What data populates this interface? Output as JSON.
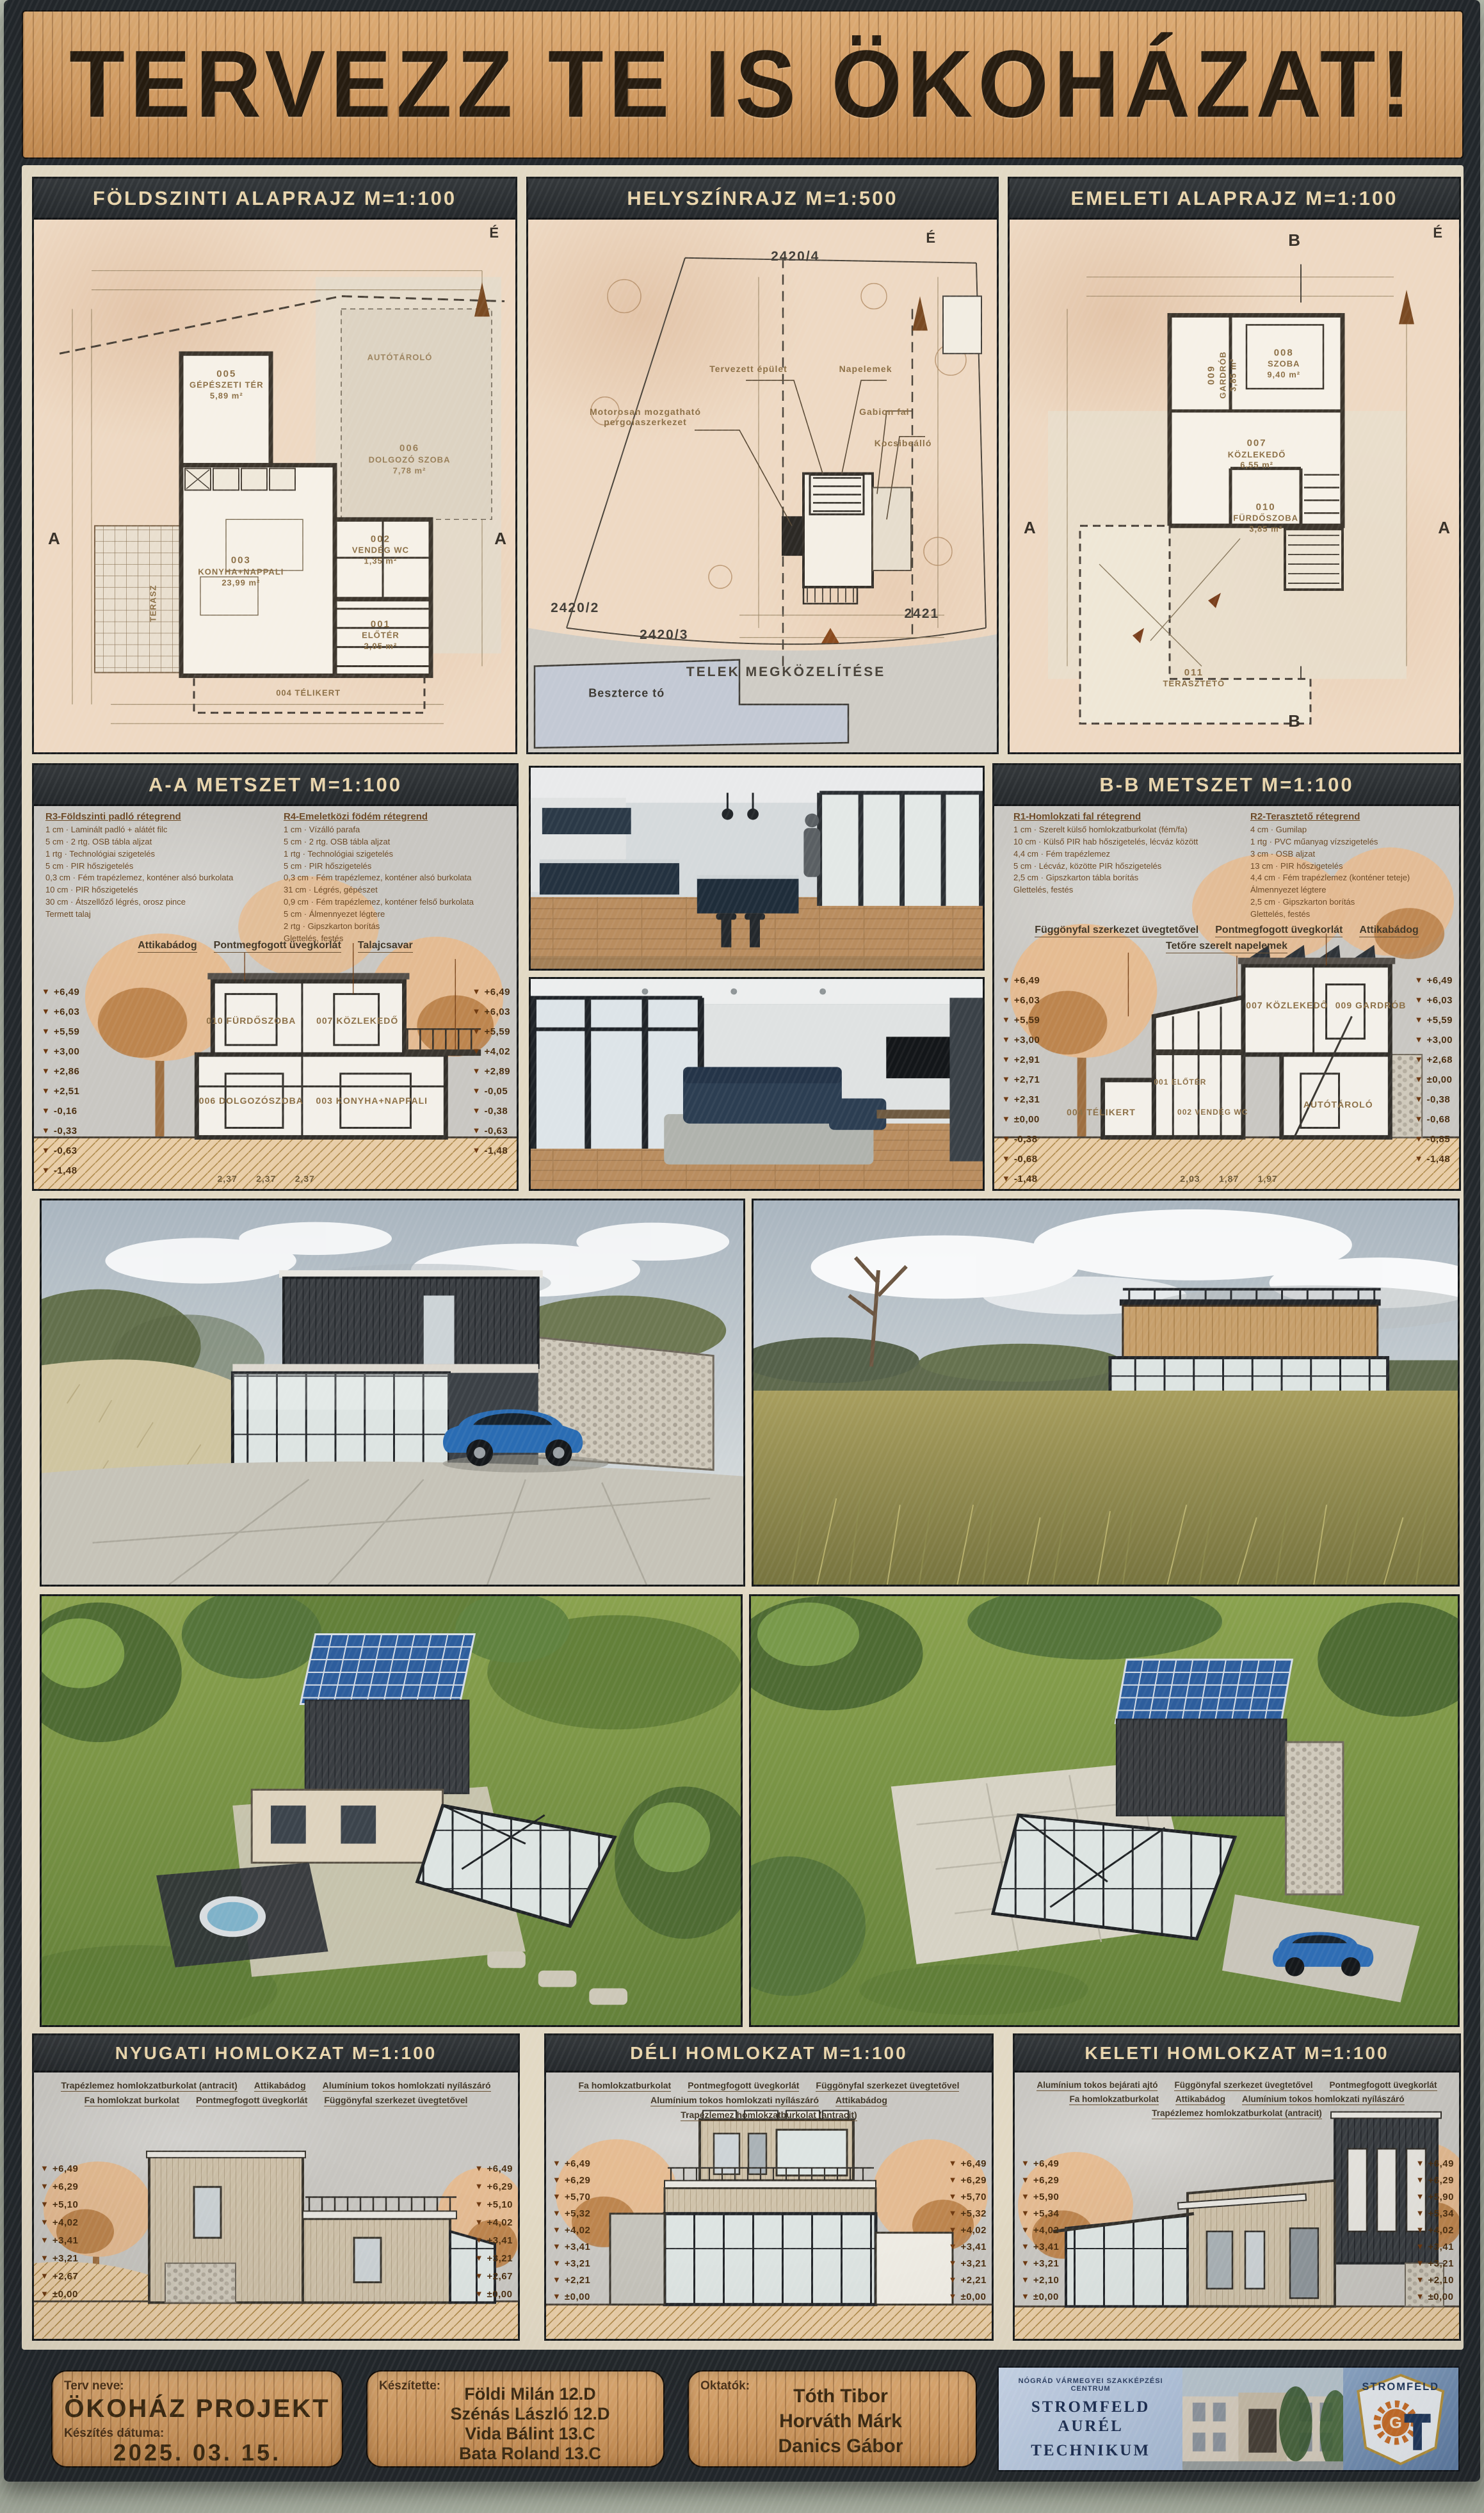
{
  "title": "TERVEZZ TE IS ÖKOHÁZAT!",
  "plans": {
    "ground": {
      "title": "FÖLDSZINTI ALAPRAJZ M=1:100",
      "north": "É",
      "section_mark": "A",
      "terrace": "TERASZ",
      "winter_garden": "004 TÉLIKERT",
      "rooms": [
        {
          "id": "005",
          "name": "GÉPÉSZETI TÉR",
          "area": "5,89 m²"
        },
        {
          "id": "",
          "name": "AUTÓTÁROLÓ",
          "area": ""
        },
        {
          "id": "006",
          "name": "DOLGOZÓ SZOBA",
          "area": "7,78 m²"
        },
        {
          "id": "003",
          "name": "KONYHA+NAPPALI",
          "area": "23,99 m²"
        },
        {
          "id": "002",
          "name": "VENDÉG WC",
          "area": "1,35 m²"
        },
        {
          "id": "001",
          "name": "ELŐTÉR",
          "area": "2,05 m²"
        }
      ]
    },
    "site": {
      "title": "HELYSZÍNRAJZ M=1:500",
      "north": "É",
      "parcels": [
        "2420/4",
        "2420/2",
        "2420/3",
        "2421"
      ],
      "callouts": [
        "Tervezett épület",
        "Napelemek",
        "Motorosan mozgatható pergolaszerkezet",
        "Gabion fal",
        "Kocsibeálló"
      ],
      "access": "TELEK MEGKÖZELÍTÉSE",
      "lake": "Beszterce tó"
    },
    "upper": {
      "title": "EMELETI ALAPRAJZ M=1:100",
      "north": "É",
      "section_mark": "B",
      "rooms": [
        {
          "id": "009",
          "name": "GARDRÓB",
          "area": "3,85 m²"
        },
        {
          "id": "008",
          "name": "SZOBA",
          "area": "9,40 m²"
        },
        {
          "id": "007",
          "name": "KÖZLEKEDŐ",
          "area": "6,55 m²"
        },
        {
          "id": "010",
          "name": "FÜRDŐSZOBA",
          "area": "3,85 m²"
        },
        {
          "id": "011",
          "name": "TERASZTETŐ",
          "area": ""
        }
      ]
    }
  },
  "sections": {
    "aa": {
      "title": "A-A METSZET M=1:100",
      "legend1": {
        "heading": "R3-Földszinti padló rétegrend",
        "rows": [
          "1 cm · Laminált padló + alátét filc",
          "5 cm · 2 rtg. OSB tábla aljzat",
          "1 rtg · Technológiai szigetelés",
          "5 cm · PIR hőszigetelés",
          "0,3 cm · Fém trapézlemez, konténer alsó burkolata",
          "10 cm · PIR hőszigetelés",
          "30 cm · Átszellőző légrés, orosz pince",
          "Termett talaj"
        ]
      },
      "legend2": {
        "heading": "R4-Emeletközi födém rétegrend",
        "rows": [
          "1 cm · Vízálló parafa",
          "5 cm · 2 rtg. OSB tábla aljzat",
          "1 rtg · Technológiai szigetelés",
          "5 cm · PIR hőszigetelés",
          "0,3 cm · Fém trapézlemez, konténer alsó burkolata",
          "31 cm · Légrés, gépészet",
          "0,9 cm · Fém trapézlemez, konténer felső burkolata",
          "5 cm · Álmennyezet légtere",
          "2 rtg · Gipszkarton borítás",
          "Glettelés, festés"
        ]
      },
      "callouts": [
        "Attikabádog",
        "Pontmegfogott üvegkorlát",
        "Talajcsavar"
      ],
      "levels_left": [
        "+6,49",
        "+6,03",
        "+5,59",
        "+3,00",
        "+2,86",
        "+2,51",
        "-0,16",
        "-0,33",
        "-0,63",
        "-1,48"
      ],
      "levels_right": [
        "+6,49",
        "+6,03",
        "+5,59",
        "+4,02",
        "+2,89",
        "-0,05",
        "-0,38",
        "-0,63",
        "-1,48"
      ],
      "rooms": [
        "010 FÜRDŐSZOBA",
        "007 KÖZLEKEDŐ",
        "006 DOLGOZÓSZOBA",
        "003 KONYHA+NAPPALI"
      ],
      "dims": "2,37      2,37      2,37"
    },
    "bb": {
      "title": "B-B METSZET M=1:100",
      "legend1": {
        "heading": "R1-Homlokzati fal rétegrend",
        "rows": [
          "1 cm · Szerelt külső homlokzatburkolat (fém/fa)",
          "10 cm · Külső PIR hab hőszigetelés, lécváz között",
          "4,4 cm · Fém trapézlemez",
          "5 cm · Lécváz, közötte PIR hőszigetelés",
          "2,5 cm · Gipszkarton tábla borítás",
          "Glettelés, festés"
        ]
      },
      "legend2": {
        "heading": "R2-Terasztető rétegrend",
        "rows": [
          "4 cm · Gumilap",
          "1 rtg · PVC műanyag vízszigetelés",
          "3 cm · OSB aljzat",
          "13 cm · PIR hőszigetelés",
          "4,4 cm · Fém trapézlemez (konténer teteje)",
          "Álmennyezet légtere",
          "2,5 cm · Gipszkarton borítás",
          "Glettelés, festés"
        ]
      },
      "callouts": [
        "Függönyfal szerkezet üvegtetővel",
        "Pontmegfogott üvegkorlát",
        "Attikabádog",
        "Tetőre szerelt napelemek"
      ],
      "levels_left": [
        "+6,49",
        "+6,03",
        "+5,59",
        "+3,00",
        "+2,91",
        "+2,71",
        "+2,31",
        "±0,00",
        "-0,38",
        "-0,68",
        "-1,48"
      ],
      "levels_right": [
        "+6,49",
        "+6,03",
        "+5,59",
        "+3,00",
        "+2,68",
        "±0,00",
        "-0,38",
        "-0,68",
        "-0,85",
        "-1,48"
      ],
      "rooms": [
        "004 TÉLIKERT",
        "001 ELŐTÉR",
        "002 VENDÉG WC",
        "007 KÖZLEKEDŐ",
        "009 GARDRÓB",
        "AUTÓTÁROLÓ"
      ],
      "dims": "2,03      1,87      1,97"
    }
  },
  "elevations": {
    "west": {
      "title": "NYUGATI HOMLOKZAT M=1:100",
      "callouts": [
        "Trapézlemez homlokzatburkolat (antracit)",
        "Attikabádog",
        "Alumínium tokos homlokzati nyílászáró",
        "Fa homlokzat burkolat",
        "Pontmegfogott üvegkorlát",
        "Függönyfal szerkezet üvegtetővel"
      ],
      "levels": [
        "+6,49",
        "+6,29",
        "+5,10",
        "+4,02",
        "+3,41",
        "+3,21",
        "+2,67",
        "±0,00"
      ]
    },
    "south": {
      "title": "DÉLI HOMLOKZAT M=1:100",
      "callouts": [
        "Fa homlokzatburkolat",
        "Pontmegfogott üvegkorlát",
        "Függönyfal szerkezet üvegtetővel",
        "Alumínium tokos homlokzati nyílászáró",
        "Attikabádog",
        "Trapézlemez homlokzatburkolat (antracit)"
      ],
      "levels": [
        "+6,49",
        "+6,29",
        "+5,70",
        "+5,32",
        "+4,02",
        "+3,41",
        "+3,21",
        "+2,21",
        "±0,00"
      ]
    },
    "east": {
      "title": "KELETI HOMLOKZAT M=1:100",
      "callouts": [
        "Alumínium tokos bejárati ajtó",
        "Függönyfal szerkezet üvegtetővel",
        "Pontmegfogott üvegkorlát",
        "Fa homlokzatburkolat",
        "Attikabádog",
        "Alumínium tokos homlokzati nyílászáró",
        "Trapézlemez homlokzatburkolat (antracit)"
      ],
      "levels": [
        "+6,49",
        "+6,29",
        "+5,90",
        "+5,34",
        "+4,02",
        "+3,41",
        "+3,21",
        "+2,10",
        "±0,00"
      ]
    }
  },
  "footer": {
    "project_label": "Terv neve:",
    "project_name": "ÖKOHÁZ PROJEKT",
    "date_label": "Készítés dátuma:",
    "date": "2025. 03. 15.",
    "authors_label": "Készítette:",
    "authors": [
      "Földi Milán 12.D",
      "Szénás László 12.D",
      "Vida Bálint 13.C",
      "Bata Roland 13.C"
    ],
    "teachers_label": "Oktatók:",
    "teachers": [
      "Tóth Tibor",
      "Horváth Márk",
      "Danics Gábor"
    ],
    "school": {
      "centrum": "NÓGRÁD VÁRMEGYEI SZAKKÉPZÉSI CENTRUM",
      "name_line1": "STROMFELD AURÉL",
      "name_line2": "TECHNIKUM",
      "logo_arc": "STROMFELD",
      "logo_g": "G",
      "logo_t": "T"
    }
  }
}
